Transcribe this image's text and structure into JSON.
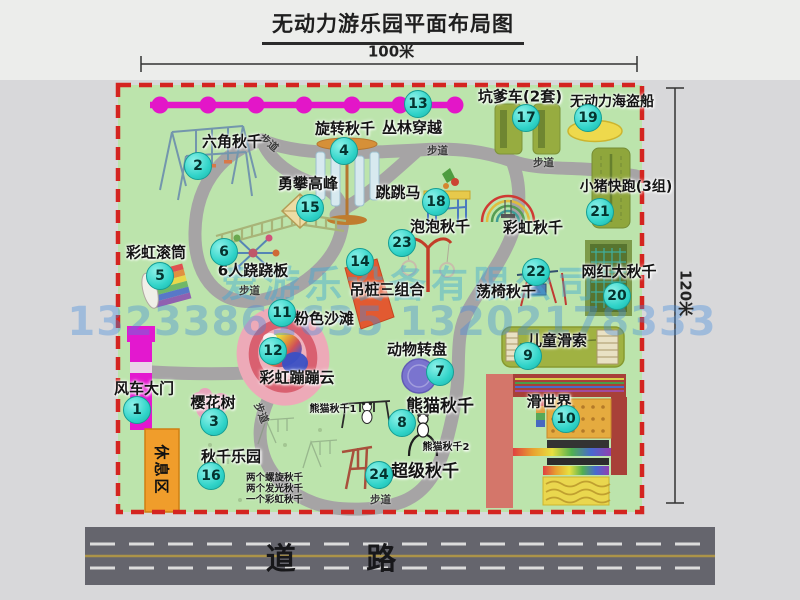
{
  "title": "无动力游乐园平面布局图",
  "dimensions": {
    "width_label": "100米",
    "height_label": "120米"
  },
  "road_label": "道 路",
  "rest_area_label": "休息区",
  "path_label": "步道",
  "rainbow_swing_label": "彩虹秋千",
  "panda_sub1": "熊猫秋千1",
  "panda_sub2": "熊猫秋千2",
  "swing_park_notes": [
    "两个螺旋秋千",
    "两个发光秋千",
    "一个彩虹秋千"
  ],
  "watermark": {
    "company": "爱游乐设备有限公司",
    "phones": "13233861635 13202178333"
  },
  "attractions": [
    {
      "num": "1",
      "name": "风车大门"
    },
    {
      "num": "2",
      "name": "六角秋千"
    },
    {
      "num": "3",
      "name": "樱花树"
    },
    {
      "num": "4",
      "name": "旋转秋千"
    },
    {
      "num": "5",
      "name": "彩虹滚筒"
    },
    {
      "num": "6",
      "name": "6人跷跷板"
    },
    {
      "num": "7",
      "name": "动物转盘"
    },
    {
      "num": "8",
      "name": "熊猫秋千"
    },
    {
      "num": "9",
      "name": "儿童滑索"
    },
    {
      "num": "10",
      "name": "滑世界"
    },
    {
      "num": "11",
      "name": "粉色沙滩"
    },
    {
      "num": "12",
      "name": "彩虹蹦蹦云"
    },
    {
      "num": "13",
      "name": "丛林穿越"
    },
    {
      "num": "14",
      "name": "吊桩三组合"
    },
    {
      "num": "15",
      "name": "勇攀高峰"
    },
    {
      "num": "16",
      "name": "秋千乐园"
    },
    {
      "num": "17",
      "name": "坑爹车(2套)"
    },
    {
      "num": "18",
      "name": "跳跳马"
    },
    {
      "num": "19",
      "name": "无动力海盗船"
    },
    {
      "num": "20",
      "name": "网红大秋千"
    },
    {
      "num": "21",
      "name": "小猪快跑(3组)"
    },
    {
      "num": "22",
      "name": "荡椅秋千"
    },
    {
      "num": "23",
      "name": "泡泡秋千"
    },
    {
      "num": "24",
      "name": "超级秋千"
    }
  ],
  "icons": [
    "zipline",
    "walking-path",
    "windmill-gate",
    "rest-area-box",
    "road",
    "pink-beach",
    "rainbow-cloud",
    "dimension-line"
  ],
  "colors": {
    "park_green": "#bce4ac",
    "border_red": "#d42420",
    "badge_teal": "#2fd3c8",
    "gate_magenta": "#e318cf",
    "road_gray": "#65656d",
    "rest_orange": "#f09d2b",
    "watermark_blue": "rgba(66,140,220,0.4)"
  }
}
